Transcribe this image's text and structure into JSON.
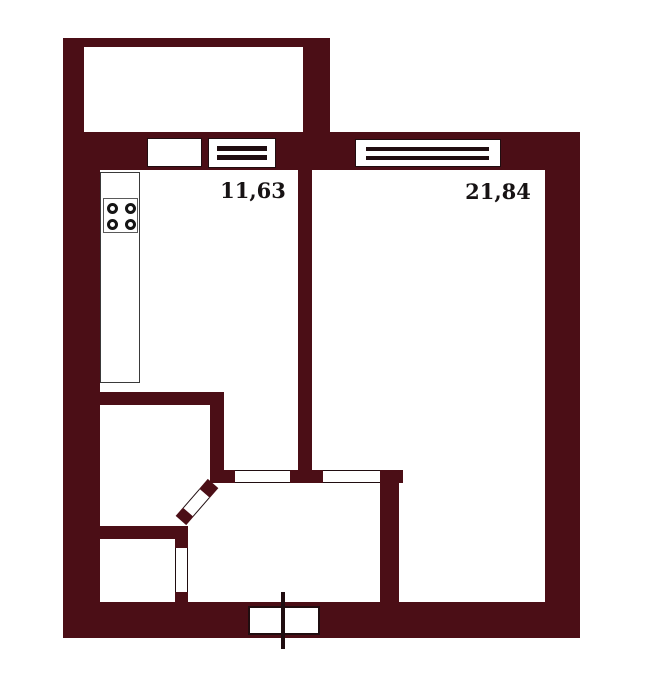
{
  "plan": {
    "type": "apartment-floor-plan",
    "rooms": [
      {
        "name": "kitchen",
        "area_label": "11,63"
      },
      {
        "name": "living-room",
        "area_label": "21,84"
      }
    ],
    "fixtures": {
      "stove_icon": "stove-4-burner-icon",
      "kitchen_counter": "counter",
      "entry_door": "entry-door-icon",
      "windows": 2,
      "balcony_door": 1
    }
  },
  "colors": {
    "wall": "#4b0e16",
    "line": "#200d10",
    "bg": "#ffffff",
    "text": "#171314"
  }
}
